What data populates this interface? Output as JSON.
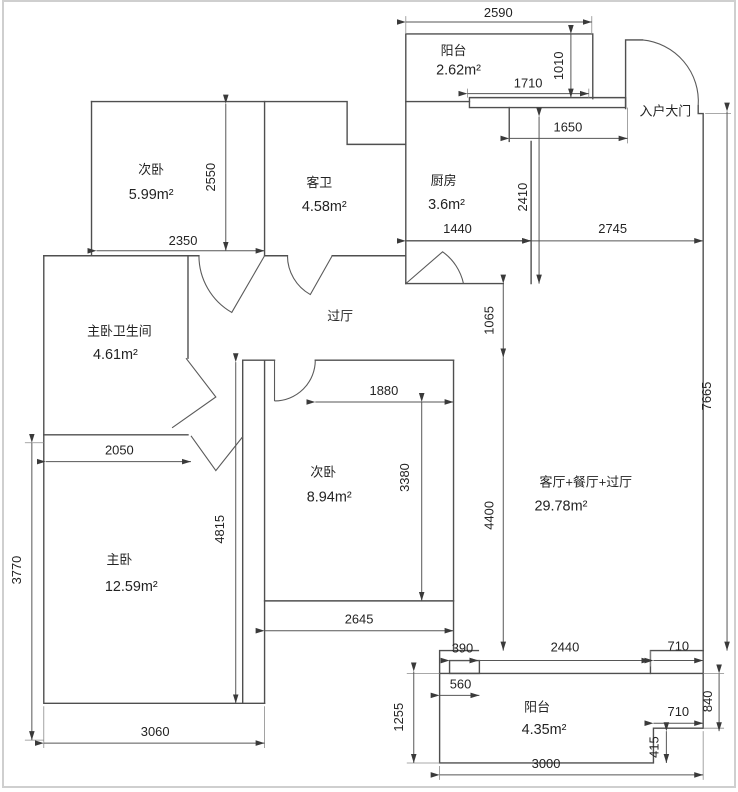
{
  "plan": {
    "rooms": {
      "balcony_top": {
        "name": "阳台",
        "area": "2.62m²"
      },
      "bedroom_top": {
        "name": "次卧",
        "area": "5.99m²"
      },
      "guest_bath": {
        "name": "客卫",
        "area": "4.58m²"
      },
      "kitchen": {
        "name": "厨房",
        "area": "3.6m²"
      },
      "entrance": {
        "name": "入户大门"
      },
      "hallway": {
        "name": "过厅"
      },
      "master_bath": {
        "name": "主卧卫生间",
        "area": "4.61m²"
      },
      "bedroom_mid": {
        "name": "次卧",
        "area": "8.94m²"
      },
      "living": {
        "name": "客厅+餐厅+过厅",
        "area": "29.78m²"
      },
      "master_bedroom": {
        "name": "主卧",
        "area": "12.59m²"
      },
      "balcony_bottom": {
        "name": "阳台",
        "area": "4.35m²"
      }
    },
    "dims": {
      "top_balcony_width": "2590",
      "entry_step": "1710",
      "balcony_depth": "1010",
      "entry_width": "1650",
      "entry_hall_depth": "2410",
      "kitchen_width": "1440",
      "entry_to_right_wall": "2745",
      "bedroom1_width": "2350",
      "bedroom1_depth": "2550",
      "hall_passage": "1065",
      "living_length": "4400",
      "right_side_total": "7665",
      "bedroom2_width": "1880",
      "bedroom2_depth": "3380",
      "master_top_width": "2050",
      "master_left_height": "3770",
      "middle_column_height": "4815",
      "bedroom2_bottom": "2645",
      "master_bottom_width": "3060",
      "ledge_width": "390",
      "balcony2_opening": "2440",
      "notch_top": "710",
      "balcony2_inset": "560",
      "notch_bottom": "710",
      "notch_height": "840",
      "notch_small": "415",
      "balcony2_left_height": "1255",
      "balcony2_bottom": "3000"
    },
    "colors": {
      "wall": "#4f4f4f",
      "dimension": "#565656",
      "text": "#232323",
      "background": "#ffffff",
      "frame": "#cfcfcf"
    }
  }
}
